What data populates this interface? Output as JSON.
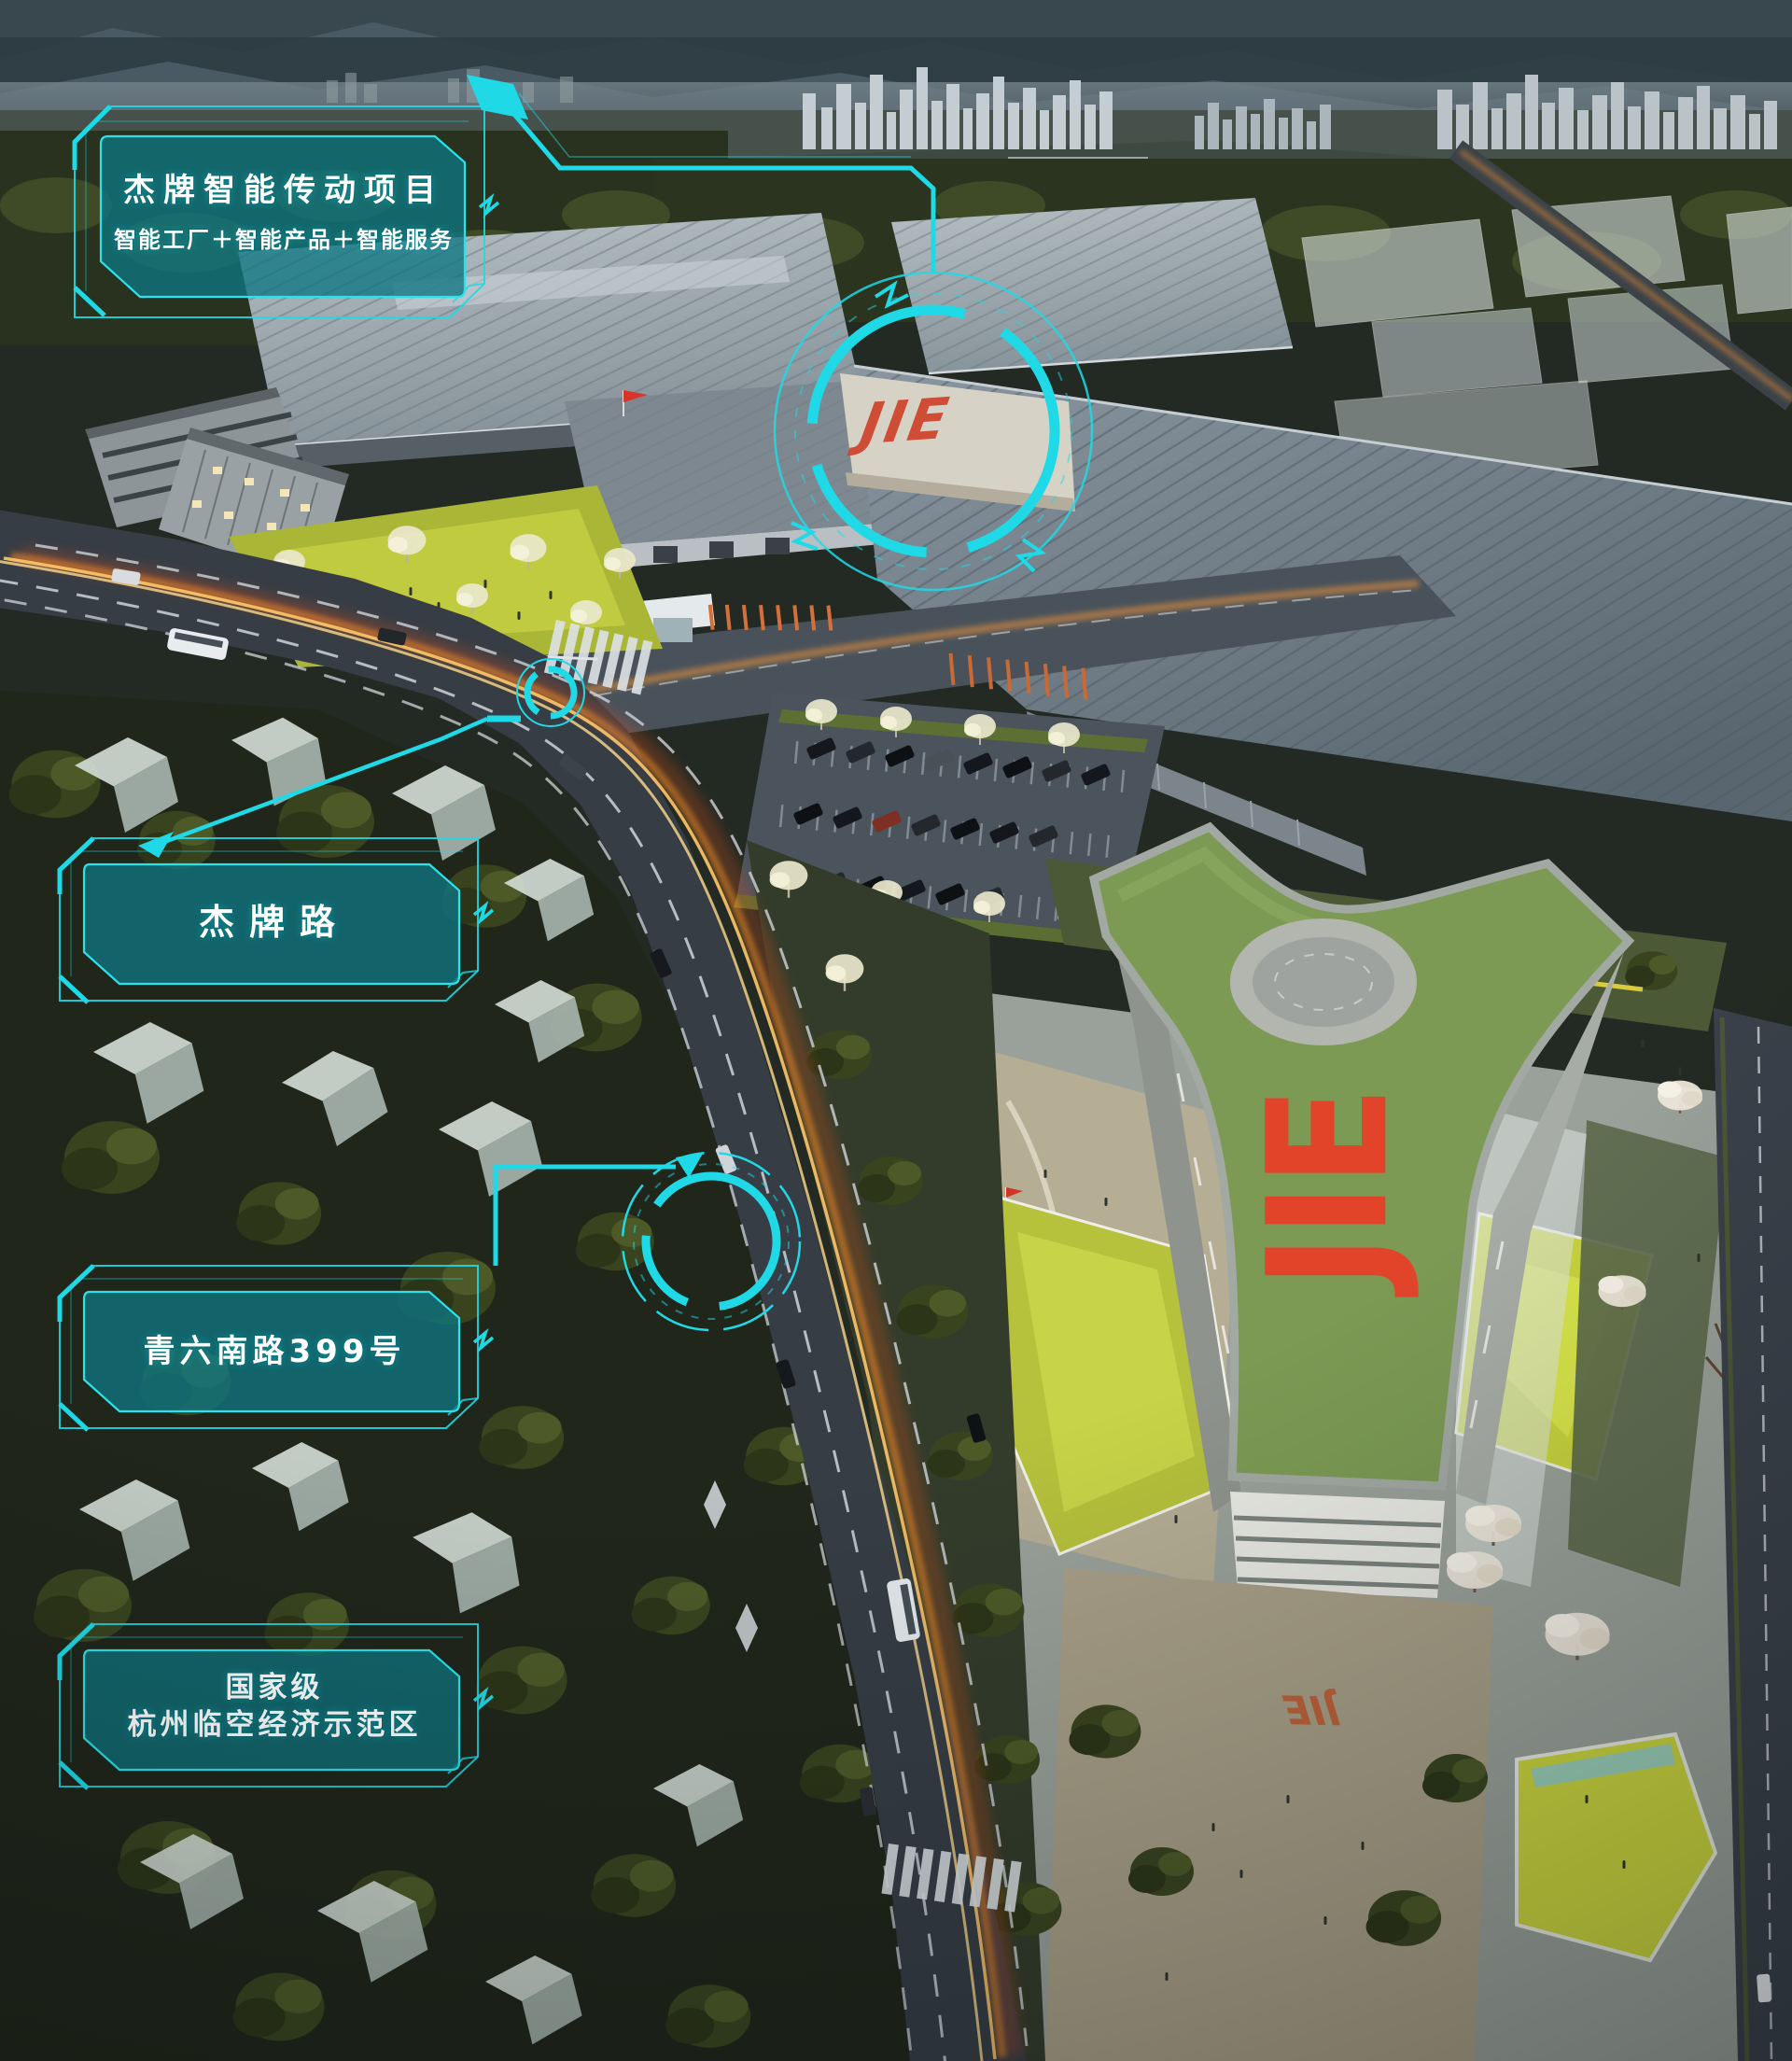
{
  "callouts": {
    "project": {
      "title": "杰牌智能传动项目",
      "subtitle": "智能工厂＋智能产品＋智能服务"
    },
    "road": {
      "label": "杰牌路"
    },
    "address": {
      "label": "青六南路399号"
    },
    "zone": {
      "line1": "国家级",
      "line2": "杭州临空经济示范区"
    }
  },
  "logos": {
    "facade": "JIE",
    "roof": "JIE",
    "ground": "JIE"
  },
  "colors": {
    "hud_cyan": "#1fd9e6",
    "hud_fill_teal": "#0d7a86",
    "logo_red": "#e2442a",
    "lawn_yellow_green": "#b8c43d",
    "roof_green": "#7c9a54",
    "light_trail_orange": "#ff8c28"
  }
}
